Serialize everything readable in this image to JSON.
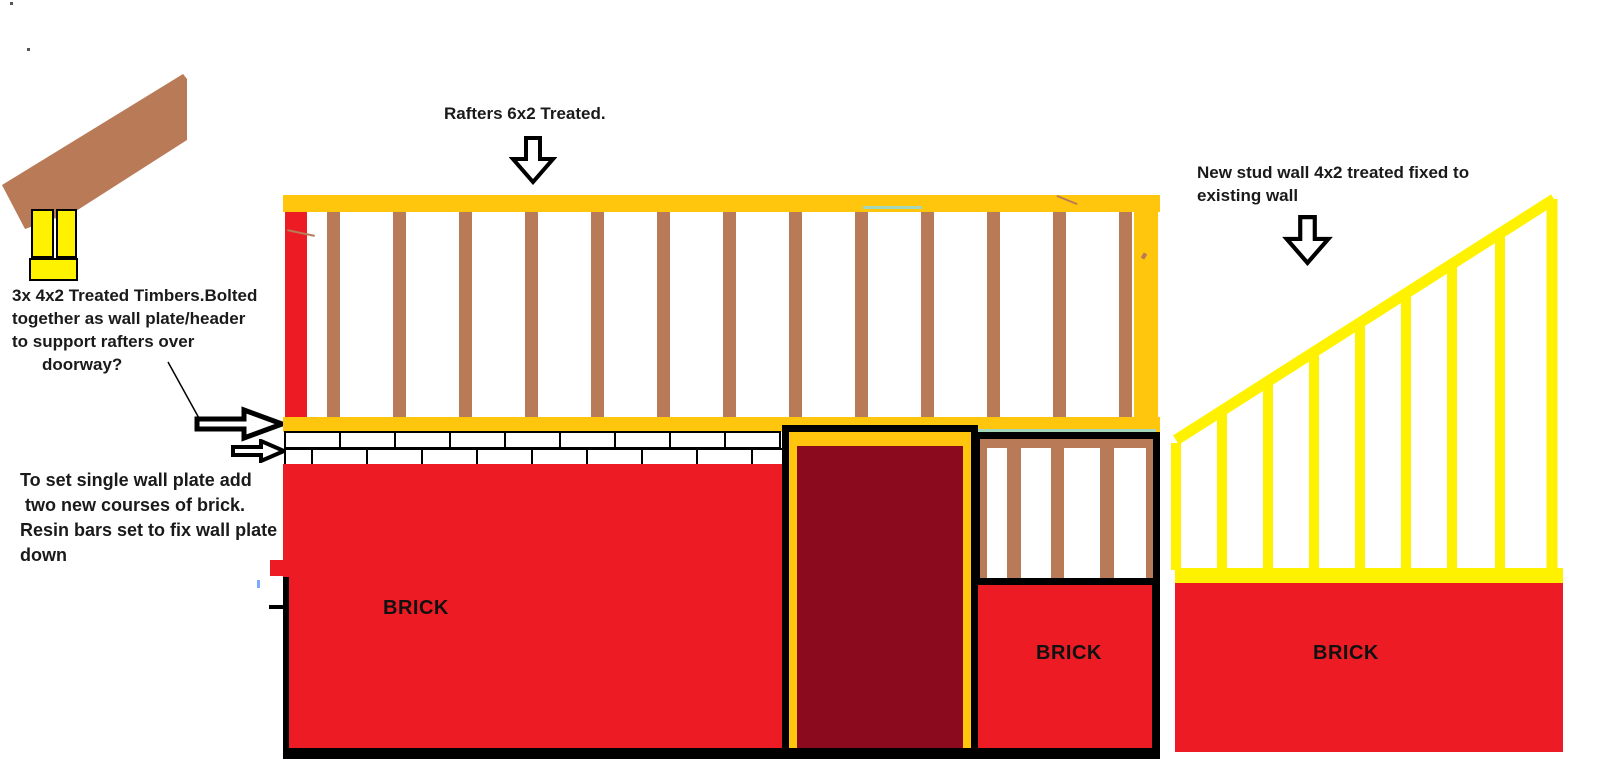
{
  "labels": {
    "rafters": "Rafters 6x2 Treated.",
    "timbers_note_lines": [
      "3x 4x2 Treated Timbers.Bolted",
      "together as wall plate/header",
      "to support rafters over",
      "doorway?"
    ],
    "wallplate_note_lines": [
      "To set single wall plate add",
      " two new courses of brick.",
      "Resin bars set to fix wall plate",
      "down"
    ],
    "studwall_note_lines": [
      "New stud wall 4x2 treated fixed to",
      "existing wall"
    ],
    "brick_left": "BRICK",
    "brick_middle": "BRICK",
    "brick_right": "BRICK"
  },
  "colors": {
    "red": "#ED1C24",
    "dark_red": "#8B0A1E",
    "gold": "#FFC60D",
    "yellow": "#FFF200",
    "brown": "#B97A57",
    "black": "#000000",
    "white": "#FFFFFF",
    "teal_artifact": "#A4D6BC",
    "blue_artifact": "#7FA8FF",
    "dot_artifact": "#555555"
  },
  "structure": {
    "rafters": {
      "count": 13,
      "x0": 327,
      "spacing": 66,
      "width": 13,
      "y": 212,
      "height": 205
    },
    "bricks": {
      "x0": 284,
      "x1": 783,
      "y0": 431,
      "row_h": 18,
      "brick_w": 55,
      "first_widths": [
        55,
        27
      ]
    },
    "small_studs": {
      "xs": [
        980,
        1007,
        1051,
        1100,
        1146
      ],
      "ws": [
        7,
        14,
        13,
        14,
        7
      ],
      "y": 448,
      "height": 130
    },
    "triangle": {
      "left": 1150,
      "top": 170,
      "w": 450,
      "h": 430,
      "hyp": [
        [
          26,
          270
        ],
        [
          404,
          29
        ]
      ],
      "right_edge_x": 402,
      "right_edge_top": 29,
      "stud_xs": [
        26,
        72,
        118,
        164,
        210,
        256,
        302,
        350
      ],
      "stud_bottom": 400,
      "hyp_stroke": 11,
      "stud_stroke": 10
    }
  }
}
